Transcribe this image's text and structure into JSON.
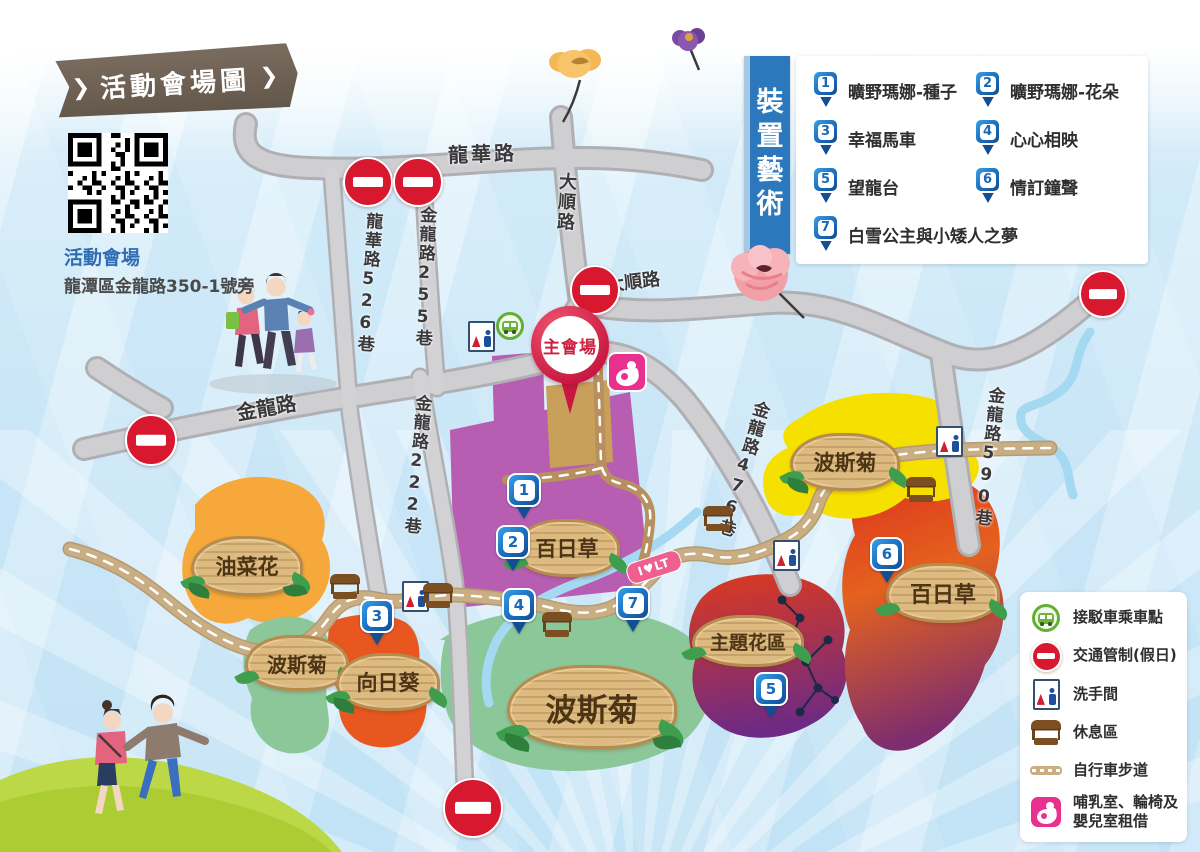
{
  "title_banner": {
    "text": "活動會場圖",
    "chevron": "❯"
  },
  "venue_info": {
    "name": "活動會場",
    "address": "龍潭區金龍路350-1號旁"
  },
  "art_legend": {
    "title": "裝置藝術",
    "items": [
      {
        "num": "1",
        "label": "曠野瑪娜-種子"
      },
      {
        "num": "2",
        "label": "曠野瑪娜-花朵"
      },
      {
        "num": "3",
        "label": "幸福馬車"
      },
      {
        "num": "4",
        "label": "心心相映"
      },
      {
        "num": "5",
        "label": "望龍台"
      },
      {
        "num": "6",
        "label": "情訂鐘聲"
      },
      {
        "num": "7",
        "label": "白雪公主與小矮人之夢"
      }
    ]
  },
  "map_legend": {
    "items": [
      {
        "icon": "shuttle-bus",
        "label": "接駁車乘車點"
      },
      {
        "icon": "no-entry",
        "label": "交通管制(假日)"
      },
      {
        "icon": "restroom",
        "label": "洗手間"
      },
      {
        "icon": "rest-area",
        "label": "休息區"
      },
      {
        "icon": "bike-path",
        "label": "自行車步道"
      },
      {
        "icon": "nursing-room",
        "label": "哺乳室、輪椅及嬰兒室租借"
      }
    ]
  },
  "map": {
    "main_venue": "主會場",
    "trail_sign": "I♥LT",
    "roads": [
      {
        "text": "龍華路"
      },
      {
        "text": "大順路"
      },
      {
        "text": "大順路"
      },
      {
        "text": "龍華路526巷"
      },
      {
        "text": "金龍路255巷"
      },
      {
        "text": "金龍路"
      },
      {
        "text": "金龍路222巷"
      },
      {
        "text": "金龍路476巷"
      },
      {
        "text": "金龍路590巷"
      }
    ],
    "areas": [
      {
        "text": "油菜花"
      },
      {
        "text": "波斯菊"
      },
      {
        "text": "向日葵"
      },
      {
        "text": "百日草"
      },
      {
        "text": "波斯菊"
      },
      {
        "text": "主題花區"
      },
      {
        "text": "波斯菊"
      },
      {
        "text": "百日草"
      }
    ],
    "pins": [
      {
        "num": "1"
      },
      {
        "num": "2"
      },
      {
        "num": "3"
      },
      {
        "num": "4"
      },
      {
        "num": "5"
      },
      {
        "num": "6"
      },
      {
        "num": "7"
      }
    ]
  },
  "colors": {
    "pin_blue": "#1d6fc0",
    "venue_red": "#c81840",
    "banner_blue": "#2b79bc",
    "ribbon_brown": "#6b5f52",
    "no_entry_red": "#d7182f",
    "nursing_pink": "#e9308f",
    "bus_green": "#63ae35",
    "road_gray": "#cfcfd2",
    "bike_path_tan": "#c9ae84"
  }
}
